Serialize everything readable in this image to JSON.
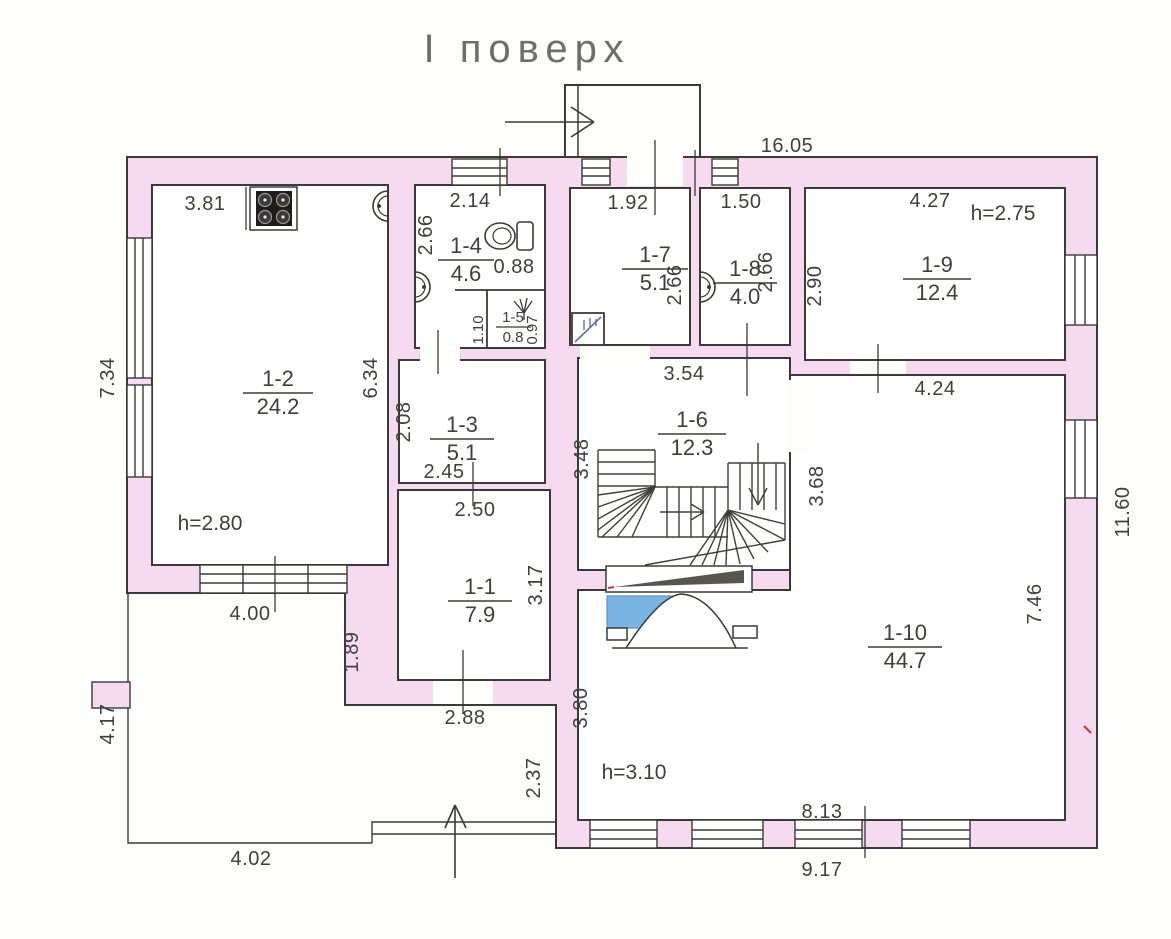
{
  "title": "І поверх",
  "rooms": [
    {
      "id": "1-1",
      "area": "7.9"
    },
    {
      "id": "1-2",
      "area": "24.2"
    },
    {
      "id": "1-3",
      "area": "5.1"
    },
    {
      "id": "1-4",
      "area": "4.6"
    },
    {
      "id": "1-5",
      "area": "0.8"
    },
    {
      "id": "1-6",
      "area": "12.3"
    },
    {
      "id": "1-7",
      "area": "5.1"
    },
    {
      "id": "1-8",
      "area": "4.0"
    },
    {
      "id": "1-9",
      "area": "12.4"
    },
    {
      "id": "1-10",
      "area": "44.7"
    }
  ],
  "heights": {
    "r2": "h=2.80",
    "r9": "h=2.75",
    "r10": "h=3.10"
  },
  "dims": {
    "top_total": "16.05",
    "r2_top": "3.81",
    "r2_right": "6.34",
    "r2_bottom": "4.00",
    "left_upper": "7.34",
    "left_lower": "4.17",
    "r4_top": "2.14",
    "r4_left": "2.66",
    "r4_inner": "0.88",
    "r5_left": "1.10",
    "r5_right": "0.97",
    "r3_left": "2.08",
    "r3_bottom": "2.45",
    "r1_top": "2.50",
    "r1_right": "3.17",
    "r1_bottom": "2.88",
    "r7_top": "1.92",
    "r7_right": "2.66",
    "r8_top": "1.50",
    "r8_right": "2.66",
    "r9_top": "4.27",
    "r9_left": "2.90",
    "r6_top": "3.54",
    "r6_left": "3.48",
    "r6_right": "3.68",
    "r10_top": "4.24",
    "r10_right": "7.46",
    "r10_left": "3.80",
    "r10_bottom_inner": "8.13",
    "bottom_outer": "9.17",
    "right_outer": "11.60",
    "terrace_right": "1.89",
    "terrace_wall": "2.37",
    "terrace_bottom": "4.02"
  },
  "colors": {
    "wall_pink": "#f5daf0",
    "line": "#3b3a34",
    "text": "#403f39",
    "fixture_blue": "#7ab4e4",
    "ramp_dark": "#57554e",
    "mark_red": "#c0392b"
  }
}
